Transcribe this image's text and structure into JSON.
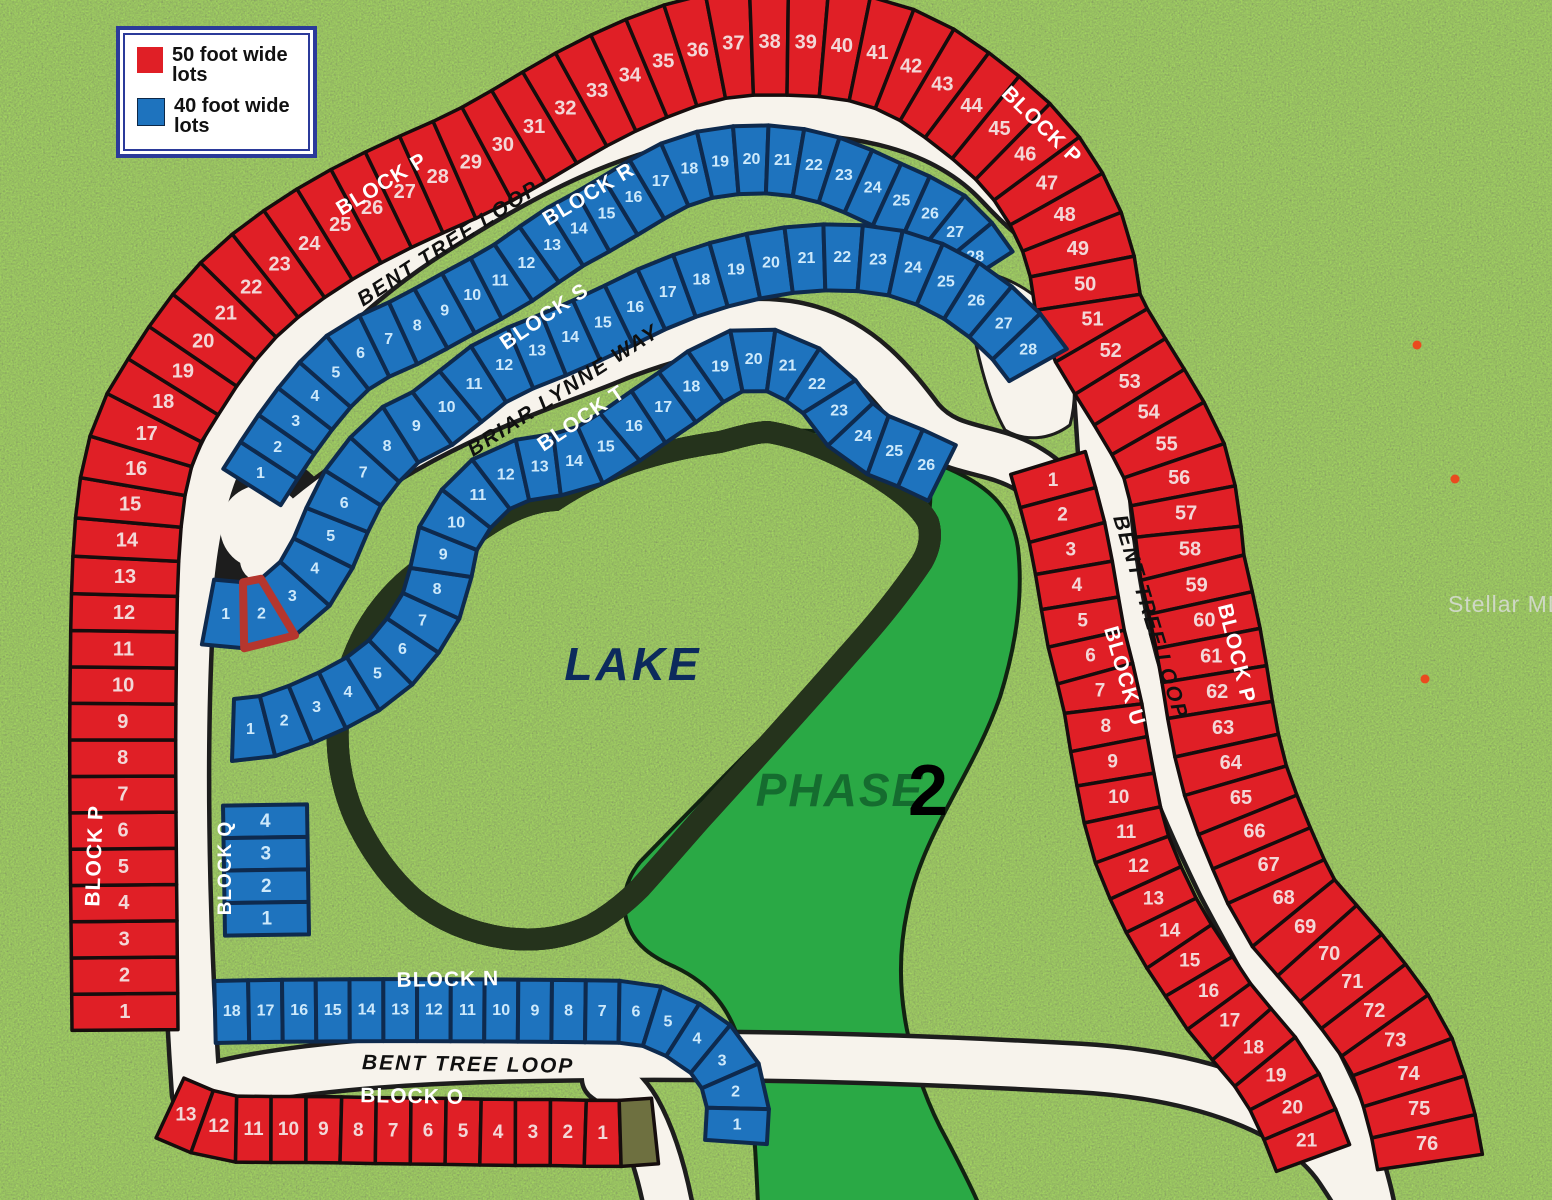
{
  "legend": {
    "items": [
      {
        "swatch_color": "#e01f26",
        "label": "50 foot wide lots"
      },
      {
        "swatch_color": "#1e73be",
        "label": "40 foot wide lots"
      }
    ]
  },
  "map": {
    "street_labels": [
      "BENT TREE LOOP",
      "BENT TREE LOOP",
      "BENT TREE LOOP",
      "BRIAR LYNNE WAY"
    ],
    "lake_label": "LAKE",
    "phase_label": "PHASE",
    "phase_number": "2",
    "watermark": "Stellar MLS",
    "highlight": {
      "block": "S",
      "lot": "2",
      "color": "#b5362e"
    },
    "colors": {
      "red_lot": "#e01f26",
      "blue_lot": "#1e73be",
      "olive_lot": "#6e7040",
      "road": "#f7f3ec",
      "lake": "#47a6d9",
      "phase_green": "#2aa945"
    },
    "blocks": [
      {
        "id": "P",
        "label": "BLOCK P",
        "type": "50 foot wide",
        "color": "red",
        "lots": [
          "1",
          "2",
          "3",
          "4",
          "5",
          "6",
          "7",
          "8",
          "9",
          "10",
          "11",
          "12",
          "13",
          "14",
          "15",
          "16",
          "17",
          "18",
          "19",
          "20",
          "21",
          "22",
          "23",
          "24",
          "25",
          "26",
          "27",
          "28",
          "29",
          "30",
          "31",
          "32",
          "33",
          "34",
          "35",
          "36",
          "37",
          "38",
          "39",
          "40",
          "41",
          "42",
          "43",
          "44",
          "45",
          "46",
          "47",
          "48",
          "49",
          "50",
          "51",
          "52",
          "53",
          "54",
          "55",
          "56",
          "57",
          "58",
          "59",
          "60",
          "61",
          "62",
          "63",
          "64",
          "65",
          "66",
          "67",
          "68",
          "69",
          "70",
          "71",
          "72",
          "73",
          "74",
          "75",
          "76"
        ]
      },
      {
        "id": "R",
        "label": "BLOCK R",
        "type": "40 foot wide",
        "color": "blue",
        "lots": [
          "1",
          "2",
          "3",
          "4",
          "5",
          "6",
          "7",
          "8",
          "9",
          "10",
          "11",
          "12",
          "13",
          "14",
          "15",
          "16",
          "17",
          "18",
          "19",
          "20",
          "21",
          "22",
          "23",
          "24",
          "25",
          "26",
          "27",
          "28"
        ]
      },
      {
        "id": "S",
        "label": "BLOCK S",
        "type": "40 foot wide",
        "color": "blue",
        "highlighted_lot": "2",
        "lots": [
          "1",
          "2",
          "3",
          "4",
          "5",
          "6",
          "7",
          "8",
          "9",
          "10",
          "11",
          "12",
          "13",
          "14",
          "15",
          "16",
          "17",
          "18",
          "19",
          "20",
          "21",
          "22",
          "23",
          "24",
          "25",
          "26",
          "27",
          "28"
        ]
      },
      {
        "id": "T",
        "label": "BLOCK T",
        "type": "40 foot wide",
        "color": "blue",
        "lots": [
          "1",
          "2",
          "3",
          "4",
          "5",
          "6",
          "7",
          "8",
          "9",
          "10",
          "11",
          "12",
          "13",
          "14",
          "15",
          "16",
          "17",
          "18",
          "19",
          "20",
          "21",
          "22",
          "23",
          "24",
          "25",
          "26"
        ]
      },
      {
        "id": "U",
        "label": "BLOCK U",
        "type": "50 foot wide",
        "color": "red",
        "lots": [
          "1",
          "2",
          "3",
          "4",
          "5",
          "6",
          "7",
          "8",
          "9",
          "10",
          "11",
          "12",
          "13",
          "14",
          "15",
          "16",
          "17",
          "18",
          "19",
          "20",
          "21"
        ]
      },
      {
        "id": "Q",
        "label": "BLOCK Q",
        "type": "40 foot wide",
        "color": "blue",
        "lots": [
          "4",
          "3",
          "2",
          "1"
        ]
      },
      {
        "id": "N",
        "label": "BLOCK N",
        "type": "40 foot wide",
        "color": "blue",
        "lots": [
          "18",
          "17",
          "16",
          "15",
          "14",
          "13",
          "12",
          "11",
          "10",
          "9",
          "8",
          "7",
          "6",
          "5",
          "4",
          "3",
          "2",
          "1"
        ]
      },
      {
        "id": "O",
        "label": "BLOCK O",
        "type": "50 foot wide",
        "color": "red",
        "lots": [
          "13",
          "12",
          "11",
          "10",
          "9",
          "8",
          "7",
          "6",
          "5",
          "4",
          "3",
          "2",
          "1",
          ""
        ]
      }
    ]
  }
}
